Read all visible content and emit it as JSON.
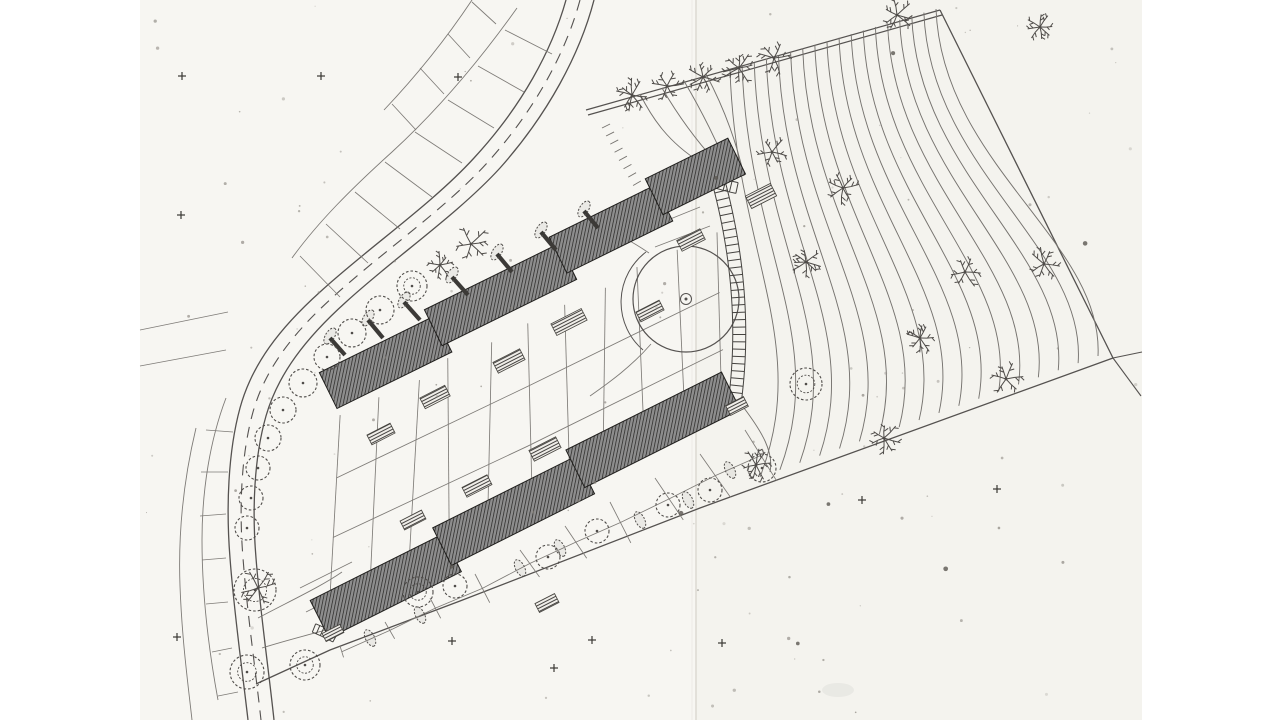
{
  "meta": {
    "kind": "scanned architectural site plan drawing",
    "description": "black-and-white site plan: two long stepped terraced-housing blocks on a hillside, curving access road with street trees on the west, topographic contour field with scattered deciduous trees on the east, garden parcels, circular plaza, long stair path, scan fold crease"
  },
  "canvas": {
    "w": 1280,
    "h": 720
  },
  "colors": {
    "bg": "#ffffff",
    "paper": "#f7f6f2",
    "paper_right": "#f4f3ee",
    "fold": "#dedbd4",
    "ink": "#555250",
    "ink_dark": "#35322f",
    "building_base": "#8d8d8d",
    "building_hatch": "#2b2a28",
    "contour": "#76736f",
    "parcel": "#7e7b77",
    "tree": "#4f4c49",
    "terrace_line": "#454341",
    "speck": "#8f8b84"
  },
  "paper": {
    "x": 140,
    "w": 1002,
    "fold_x": 696
  },
  "drawing": {
    "paths": [
      {
        "name": "road-outer-edge",
        "d": "M566,0 C552,50 522,106 474,158 C432,204 368,248 320,292 C280,328 252,364 240,408 C228,452 226,508 230,558 C234,612 242,668 248,720",
        "s": "ink",
        "w": 1.3
      },
      {
        "name": "road-inner-edge",
        "d": "M594,0 C580,54 548,114 500,168 C458,214 394,258 346,302 C306,338 278,374 266,416 C254,458 252,510 256,558 C260,610 268,664 274,720",
        "s": "ink",
        "w": 1.3
      },
      {
        "name": "road-centerline",
        "d": "M580,0 C566,52 535,110 487,163 C445,209 381,253 333,297 C293,333 265,369 253,412 C241,455 239,509 243,558 C247,611 255,666 261,720",
        "s": "ink",
        "w": 1.1,
        "da": "11,8"
      },
      {
        "name": "tree-path-line-1",
        "d": "M586,110 L940,10",
        "s": "ink",
        "w": 1.2
      },
      {
        "name": "tree-path-line-2",
        "d": "M588,115 L942,15",
        "s": "ink",
        "w": 1.2
      },
      {
        "name": "east-boundary",
        "d": "M940,10 L1113,358",
        "s": "ink",
        "w": 1.3
      },
      {
        "name": "south-boundary",
        "d": "M1113,358 L700,508 L460,601 L330,650 L256,684",
        "s": "ink",
        "w": 1.3
      },
      {
        "name": "boundary-ext-se",
        "d": "M1113,358 L1141,396",
        "s": "ink",
        "w": 1.1
      },
      {
        "name": "boundary-ext-e",
        "d": "M1113,358 L1142,352",
        "s": "ink",
        "w": 1.0
      },
      {
        "name": "nw-outer-parcel-1",
        "d": "M517,8 C480,60 440,108 392,152 C352,188 318,222 292,258",
        "s": "parcel",
        "w": 0.9
      },
      {
        "name": "nw-outer-parcel-2",
        "d": "M472,0 C448,36 420,72 384,110",
        "s": "parcel",
        "w": 0.9
      },
      {
        "name": "nw-cross-parcels",
        "d": "M505,30 L552,54 M478,66 L524,92 M448,100 L494,128 M415,132 L462,163 M385,162 L432,197 M355,192 L400,229 M326,224 L368,263 M300,256 L340,297 M472,2 L496,24 M448,34 L470,58 M420,68 L444,94 M392,104 L416,130",
        "s": "parcel",
        "w": 0.85
      },
      {
        "name": "sw-outer-parcel-1",
        "d": "M226,398 C210,440 202,490 202,540 C202,590 208,646 218,700",
        "s": "parcel",
        "w": 0.9
      },
      {
        "name": "sw-outer-parcel-2",
        "d": "M196,428 C184,478 178,532 180,586 C182,640 188,684 192,720",
        "s": "parcel",
        "w": 0.9
      },
      {
        "name": "sw-cross-parcels",
        "d": "M233,432 L206,430 M228,472 L201,472 M226,514 L200,516 M226,558 L202,560 M228,602 L206,604 M232,648 L212,652 M238,692 L218,696",
        "s": "parcel",
        "w": 0.85
      },
      {
        "name": "w-field-lines",
        "d": "M140,330 L228,312 M140,366 L226,350",
        "s": "parcel",
        "w": 0.85
      },
      {
        "name": "sw-connector-paths",
        "d": "M258,618 C292,600 322,586 342,572 M262,648 C300,636 338,628 366,618",
        "s": "parcel",
        "w": 0.9
      },
      {
        "name": "sw-garden-quads",
        "d": "M300,588 L352,562 M306,612 L358,586",
        "s": "parcel",
        "w": 0.85
      },
      {
        "name": "ne-b1-parcels",
        "d": "M648,228 L700,207 M655,247 L710,226",
        "s": "parcel",
        "w": 0.85
      },
      {
        "name": "plaza-links",
        "d": "M651,344 C632,366 610,382 590,396 M649,253 C630,240 614,232 600,228",
        "s": "parcel",
        "w": 0.9
      },
      {
        "name": "contour-starters",
        "d": "M640,94 C652,118 668,142 700,162 M662,88 C676,112 694,138 716,162 M684,81 C700,108 716,140 728,168 M706,74 C722,104 736,140 744,176",
        "s": "contour",
        "w": 0.95
      },
      {
        "name": "contour-lower-extra",
        "d": "M744,408 C762,432 774,452 770,472",
        "s": "contour",
        "w": 0.95
      },
      {
        "name": "plaza-arc",
        "d": "M646,252 A63,63 0 0 0 643,350",
        "s": "ink",
        "w": 1.0
      }
    ],
    "contour_fan": {
      "n": 18,
      "sx0": 730,
      "sx1": 936,
      "sy0": 70,
      "sy1": 9,
      "ex0": 760,
      "ex1": 1098,
      "ey0": 477,
      "ey1": 356
    },
    "embankment_ticks": {
      "p0": [
        602,
        128
      ],
      "cp": [
        618,
        160
      ],
      "p1": [
        638,
        194
      ],
      "n": 9,
      "len": 9
    },
    "mesh_between": {
      "t0": [
        340,
        415
      ],
      "t1": [
        716,
        232
      ],
      "b0": [
        330,
        590
      ],
      "b1": [
        726,
        400
      ],
      "n": 11,
      "longs": [
        0.36,
        0.7
      ],
      "jitter": 6,
      "seed": 11
    },
    "mesh_south": {
      "e0": [
        340,
        646
      ],
      "e1": [
        745,
        430
      ],
      "n": 10,
      "seed": 23
    },
    "buildings": [
      {
        "name": "building-1",
        "x": 322,
        "y": 378,
        "angle": -26.2,
        "rects": [
          [
            0,
            -6,
            128,
            40
          ],
          [
            122,
            -16,
            150,
            40
          ],
          [
            266,
            -26,
            118,
            40
          ],
          [
            378,
            -36,
            92,
            40
          ]
        ]
      },
      {
        "name": "building-2",
        "x": 312,
        "y": 604,
        "angle": -26.6,
        "rects": [
          [
            0,
            -4,
            148,
            42
          ],
          [
            142,
            -14,
            160,
            42
          ],
          [
            296,
            -24,
            174,
            42
          ]
        ]
      }
    ],
    "ladders": [
      {
        "name": "stair-path-long",
        "p0": [
          717,
          176
        ],
        "cp": [
          749,
          292
        ],
        "p1": [
          735,
          400
        ],
        "w": 13,
        "n": 30
      },
      {
        "name": "stair-path-top",
        "p0": [
          701,
          177
        ],
        "cp": [
          718,
          184
        ],
        "p1": [
          737,
          188
        ],
        "w": 11,
        "n": 6
      },
      {
        "name": "stair-path-small",
        "p0": [
          314,
          628
        ],
        "cp": [
          324,
          632
        ],
        "p1": [
          335,
          638
        ],
        "w": 9,
        "n": 5
      }
    ],
    "plaza": {
      "cx": 686,
      "cy": 299,
      "r": 53,
      "ring_r": 5.5,
      "dot_r": 1.5
    },
    "stubs": [
      [
        345,
        355,
        330,
        338
      ],
      [
        383,
        338,
        368,
        320
      ],
      [
        420,
        320,
        404,
        302
      ],
      [
        468,
        295,
        452,
        277
      ],
      [
        512,
        272,
        497,
        254
      ],
      [
        556,
        250,
        541,
        232
      ],
      [
        598,
        228,
        584,
        211
      ]
    ],
    "hedges": [
      [
        330,
        336,
        -58
      ],
      [
        368,
        318,
        -58
      ],
      [
        404,
        300,
        -58
      ],
      [
        452,
        275,
        -58
      ],
      [
        497,
        252,
        -58
      ],
      [
        541,
        230,
        -58
      ],
      [
        584,
        209,
        -58
      ],
      [
        520,
        568,
        63
      ],
      [
        560,
        548,
        63
      ],
      [
        640,
        520,
        63
      ],
      [
        688,
        500,
        63
      ],
      [
        730,
        470,
        63
      ],
      [
        420,
        615,
        63
      ],
      [
        370,
        638,
        63
      ]
    ],
    "terraces": [
      [
        569,
        322,
        34,
        13
      ],
      [
        509,
        361,
        30,
        12
      ],
      [
        435,
        397,
        28,
        12
      ],
      [
        381,
        434,
        26,
        11
      ],
      [
        545,
        449,
        30,
        12
      ],
      [
        477,
        486,
        28,
        11
      ],
      [
        691,
        240,
        26,
        12
      ],
      [
        761,
        196,
        28,
        14
      ],
      [
        413,
        520,
        24,
        10
      ],
      [
        547,
        603,
        22,
        10
      ],
      [
        737,
        406,
        20,
        11
      ],
      [
        333,
        633,
        20,
        9
      ],
      [
        650,
        311,
        26,
        11
      ]
    ],
    "trees_round": [
      [
        412,
        286,
        15
      ],
      [
        380,
        310,
        14
      ],
      [
        352,
        333,
        14
      ],
      [
        327,
        357,
        13
      ],
      [
        303,
        383,
        14
      ],
      [
        283,
        410,
        13
      ],
      [
        268,
        438,
        13
      ],
      [
        258,
        468,
        12
      ],
      [
        251,
        498,
        12
      ],
      [
        247,
        528,
        12
      ],
      [
        255,
        590,
        21
      ],
      [
        247,
        672,
        17
      ],
      [
        305,
        665,
        15
      ],
      [
        418,
        592,
        15
      ],
      [
        455,
        586,
        12
      ],
      [
        548,
        557,
        12
      ],
      [
        597,
        531,
        12
      ],
      [
        668,
        505,
        12
      ],
      [
        710,
        490,
        12
      ],
      [
        762,
        468,
        14
      ],
      [
        806,
        384,
        16
      ]
    ],
    "trees_branch": [
      [
        471,
        244,
        18
      ],
      [
        440,
        265,
        13
      ],
      [
        632,
        95,
        16
      ],
      [
        667,
        86,
        16
      ],
      [
        703,
        77,
        16
      ],
      [
        739,
        68,
        16
      ],
      [
        774,
        58,
        17
      ],
      [
        897,
        15,
        16
      ],
      [
        1040,
        27,
        14
      ],
      [
        772,
        152,
        15
      ],
      [
        843,
        188,
        16
      ],
      [
        806,
        262,
        15
      ],
      [
        965,
        272,
        16
      ],
      [
        1044,
        264,
        16
      ],
      [
        920,
        338,
        15
      ],
      [
        1006,
        379,
        16
      ],
      [
        884,
        438,
        16
      ],
      [
        756,
        465,
        15
      ],
      [
        258,
        588,
        20
      ]
    ],
    "crosses": [
      [
        182,
        76
      ],
      [
        181,
        215
      ],
      [
        321,
        76
      ],
      [
        458,
        77
      ],
      [
        177,
        637
      ],
      [
        452,
        641
      ],
      [
        592,
        640
      ],
      [
        722,
        643
      ],
      [
        862,
        500
      ],
      [
        997,
        489
      ],
      [
        554,
        668
      ]
    ],
    "specks": {
      "n": 120,
      "seed": 7
    },
    "smudge": {
      "cx": 838,
      "cy": 690,
      "rx": 16,
      "ry": 7
    }
  }
}
